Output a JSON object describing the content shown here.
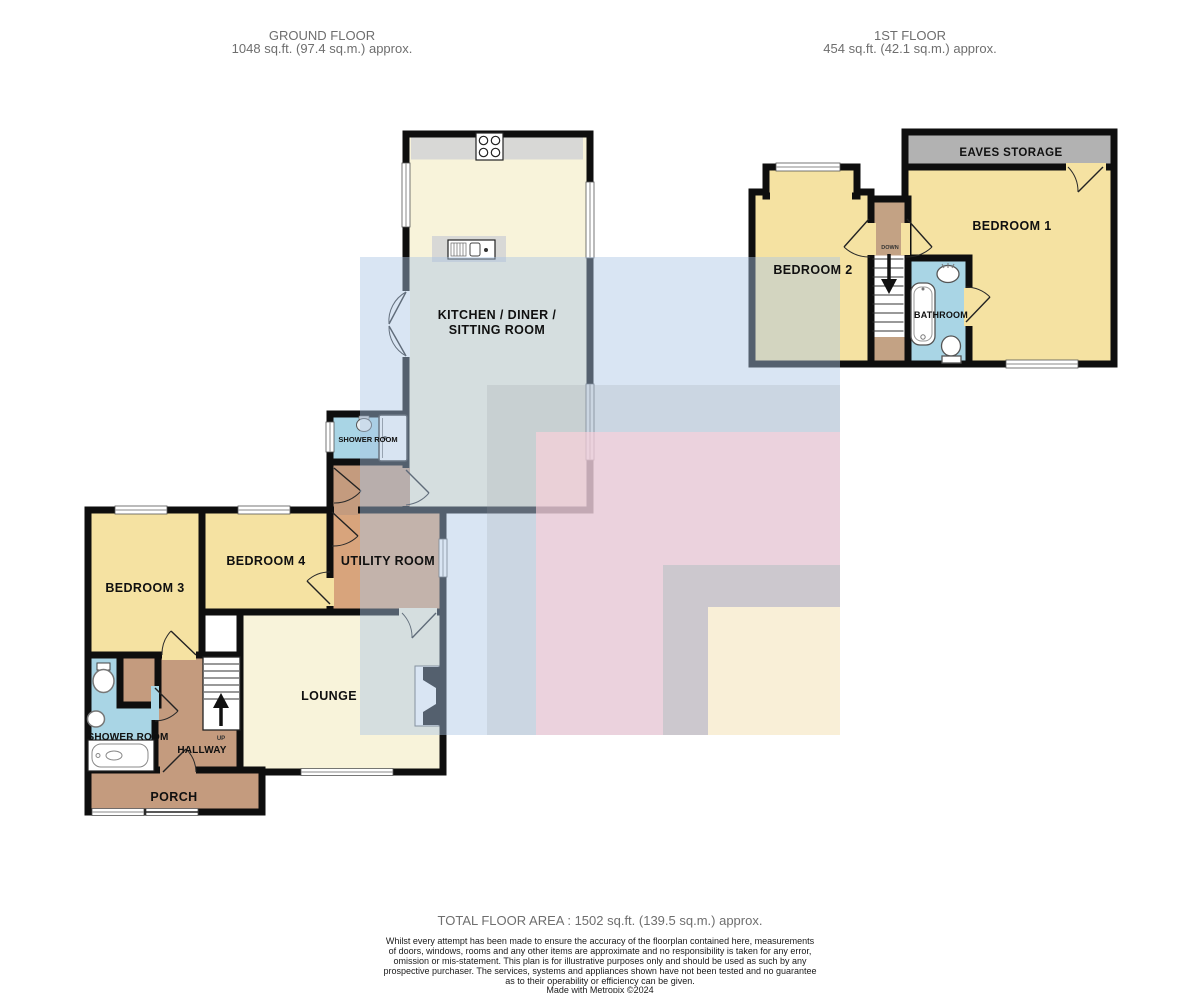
{
  "ground_floor": {
    "title": "GROUND FLOOR",
    "area": "1048 sq.ft. (97.4 sq.m.) approx.",
    "rooms": {
      "kitchen_line1": "KITCHEN / DINER /",
      "kitchen_line2": "SITTING ROOM",
      "shower_room_mid": "SHOWER ROOM",
      "bedroom3": "BEDROOM 3",
      "bedroom4": "BEDROOM 4",
      "utility": "UTILITY ROOM",
      "lounge": "LOUNGE",
      "hallway": "HALLWAY",
      "shower_room_bl": "SHOWER ROOM",
      "porch": "PORCH",
      "stairs_up": "UP"
    }
  },
  "first_floor": {
    "title": "1ST FLOOR",
    "area": "454 sq.ft. (42.1 sq.m.) approx.",
    "rooms": {
      "bedroom1": "BEDROOM 1",
      "bedroom2": "BEDROOM 2",
      "bathroom": "BATHROOM",
      "eaves": "EAVES STORAGE",
      "stairs_down": "DOWN"
    }
  },
  "footer": {
    "total_area": "TOTAL FLOOR AREA : 1502 sq.ft. (139.5 sq.m.) approx.",
    "disclaimer_lines": [
      "Whilst every attempt has been made to ensure the accuracy of the floorplan contained here, measurements",
      "of doors, windows, rooms and any other items are approximate and no responsibility is taken for any error,",
      "omission or mis-statement. This plan is for illustrative purposes only and should be used as such by any",
      "prospective purchaser. The services, systems and appliances shown have not been tested and no guarantee",
      "as to their operability or efficiency can be given."
    ],
    "credit": "Made with Metropix ©2024"
  },
  "colors": {
    "wall": "#0e0e0e",
    "room_cream": "#f8f3da",
    "room_yellow": "#f5e2a2",
    "room_blue": "#a9d5e5",
    "room_brown": "#c49b7e",
    "room_utility": "#d8a47c",
    "eaves_gray": "#b2b2b2",
    "counter_gray": "#d8d8d6",
    "overlay_blue": "rgba(170,197,228,0.45)",
    "overlay_gray": "rgba(150,153,158,0.20)",
    "overlay_pink": "rgba(255,208,218,0.62)",
    "overlay_gray2": "rgba(196,198,203,0.82)",
    "overlay_cream": "rgba(253,242,216,0.92)"
  },
  "icons": {
    "hob": "hob-icon",
    "kitchen_sink": "kitchen-sink-icon",
    "shower_cubicle": "shower-cubicle-icon",
    "shower_tray": "shower-tray-icon",
    "toilet": "toilet-icon",
    "basin": "basin-icon",
    "bath": "bath-icon",
    "stairs_up_arrow": "stairs-up-arrow-icon",
    "stairs_down_arrow": "stairs-down-arrow-icon",
    "fireplace": "fireplace-icon",
    "window": "window-icon",
    "door": "door-arc-icon"
  }
}
